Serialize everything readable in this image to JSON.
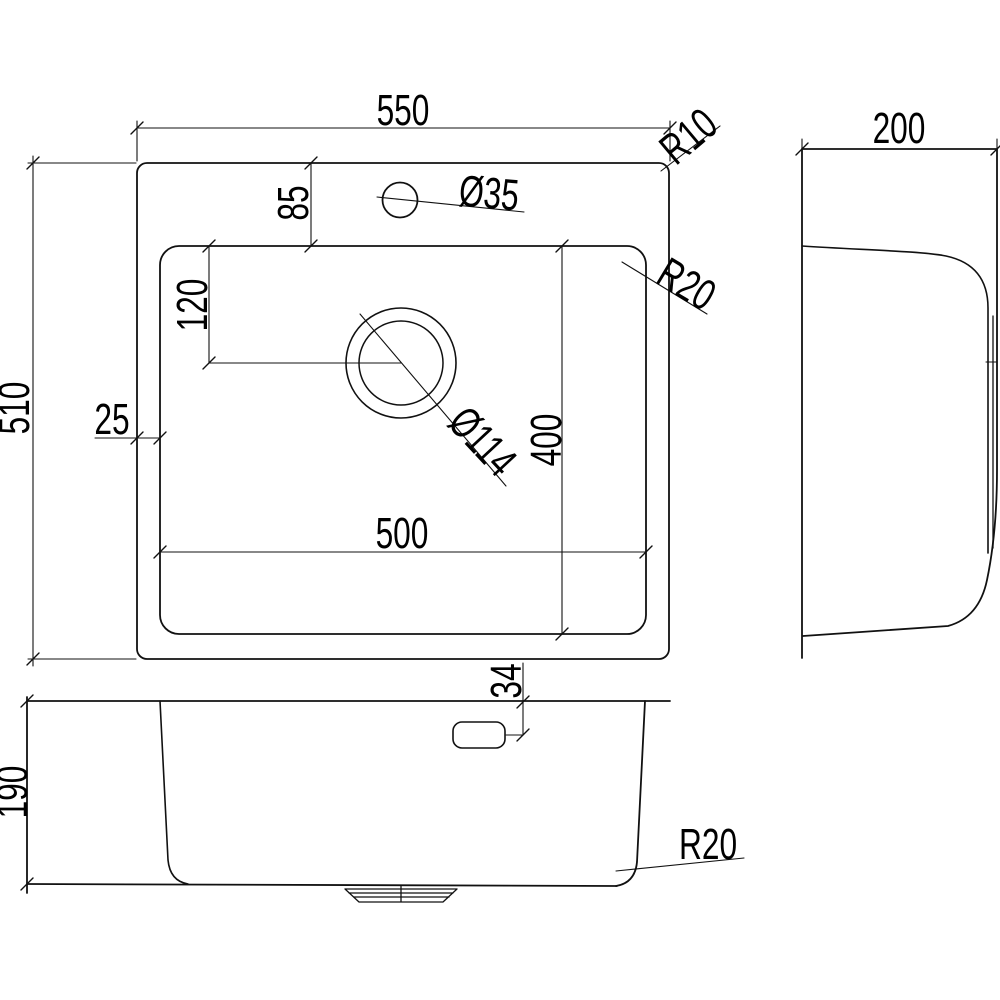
{
  "drawing": {
    "kind": "kitchen-sink technical drawing, three views",
    "views": {
      "plan": {
        "overall_width": "550",
        "overall_depth": "510",
        "deck_top_to_bowl": "85",
        "bowl_top_to_drain": "120",
        "edge_to_bowl": "25",
        "bowl_depth": "400",
        "bowl_width": "500",
        "faucet_hole_diameter": "Ø35",
        "drain_diameter": "Ø114",
        "outer_corner_radius": "R10",
        "bowl_corner_radius": "R20"
      },
      "side": {
        "width": "200"
      },
      "front": {
        "bowl_height": "190",
        "overflow_offset": "34",
        "bottom_corner_radius": "R20"
      }
    }
  }
}
